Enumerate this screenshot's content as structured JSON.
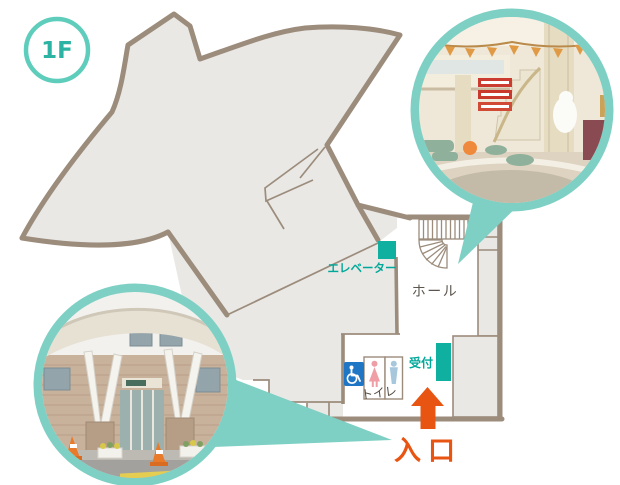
{
  "floor_badge": {
    "label": "1F"
  },
  "map": {
    "labels": {
      "elevator": "エレベーター",
      "hall": "ホール",
      "toilet": "トイレ",
      "reception": "受付",
      "entrance": "入口"
    },
    "icons": [
      "stairs-icon",
      "wheelchair-icon",
      "female-icon",
      "male-icon",
      "entrance-arrow-icon"
    ],
    "colors": {
      "wall_brown": "#9c8c7c",
      "room_gray": "#e9e8e5",
      "teal_accent": "#0fb0a0",
      "teal_text": "#00a89a",
      "teal_ring": "#7ed0c4",
      "badge_teal": "#5ecdbb",
      "label_gray": "#5d564e",
      "entrance_orange": "#e85513",
      "wheelchair_blue": "#1f76c4",
      "female_pink": "#ee9ea4",
      "male_blue": "#a6c7dc"
    },
    "photos": [
      {
        "name": "hall-interior-photo",
        "points_to": "hall / stairs"
      },
      {
        "name": "building-entrance-photo",
        "points_to": "entrance corridor"
      }
    ]
  }
}
